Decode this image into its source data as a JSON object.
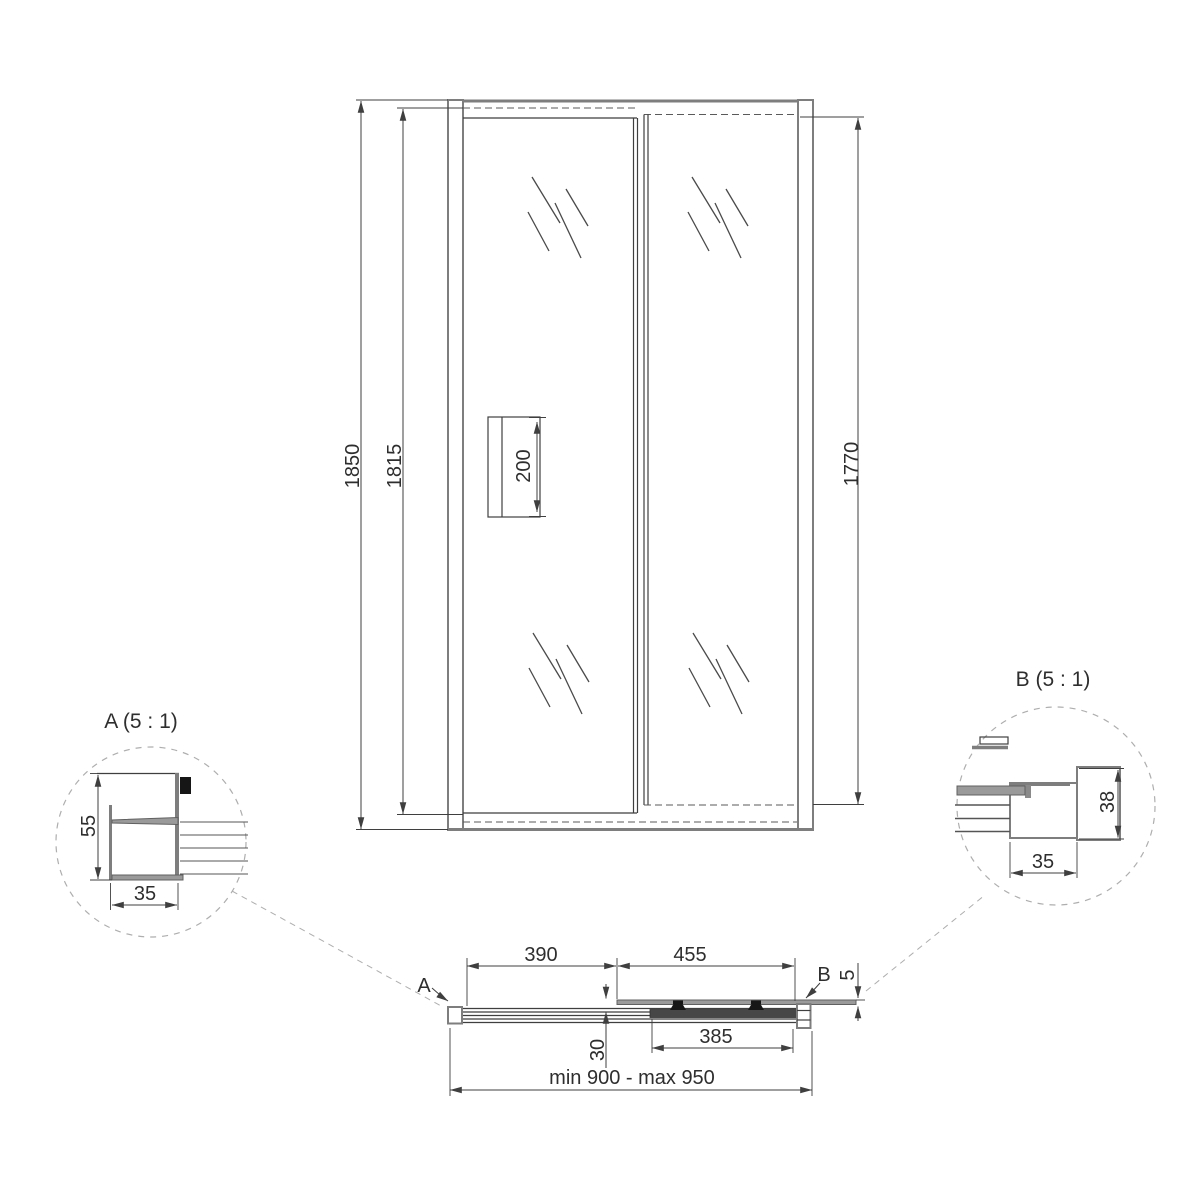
{
  "front_view": {
    "dim_overall_height": "1850",
    "dim_opening_height": "1815",
    "dim_glass_height": "1770",
    "dim_handle_length": "200"
  },
  "plan_view": {
    "dim_fixed_segment": "390",
    "dim_door_segment": "455",
    "dim_door_glass": "385",
    "dim_panel_offset": "30",
    "dim_glass_thickness": "5",
    "dim_width_range": "min 900 - max 950",
    "callout_a": "A",
    "callout_b": "B"
  },
  "detail_a": {
    "title": "A (5 : 1)",
    "dim_depth": "55",
    "dim_width": "35"
  },
  "detail_b": {
    "title": "B (5 : 1)",
    "dim_depth": "38",
    "dim_width": "35"
  },
  "colors": {
    "line_dark": "#3f3f3f",
    "line_frame": "#7e7e7e",
    "glass_gray": "#9a9a9a",
    "dash_light": "#aeaeae",
    "background": "#ffffff"
  }
}
